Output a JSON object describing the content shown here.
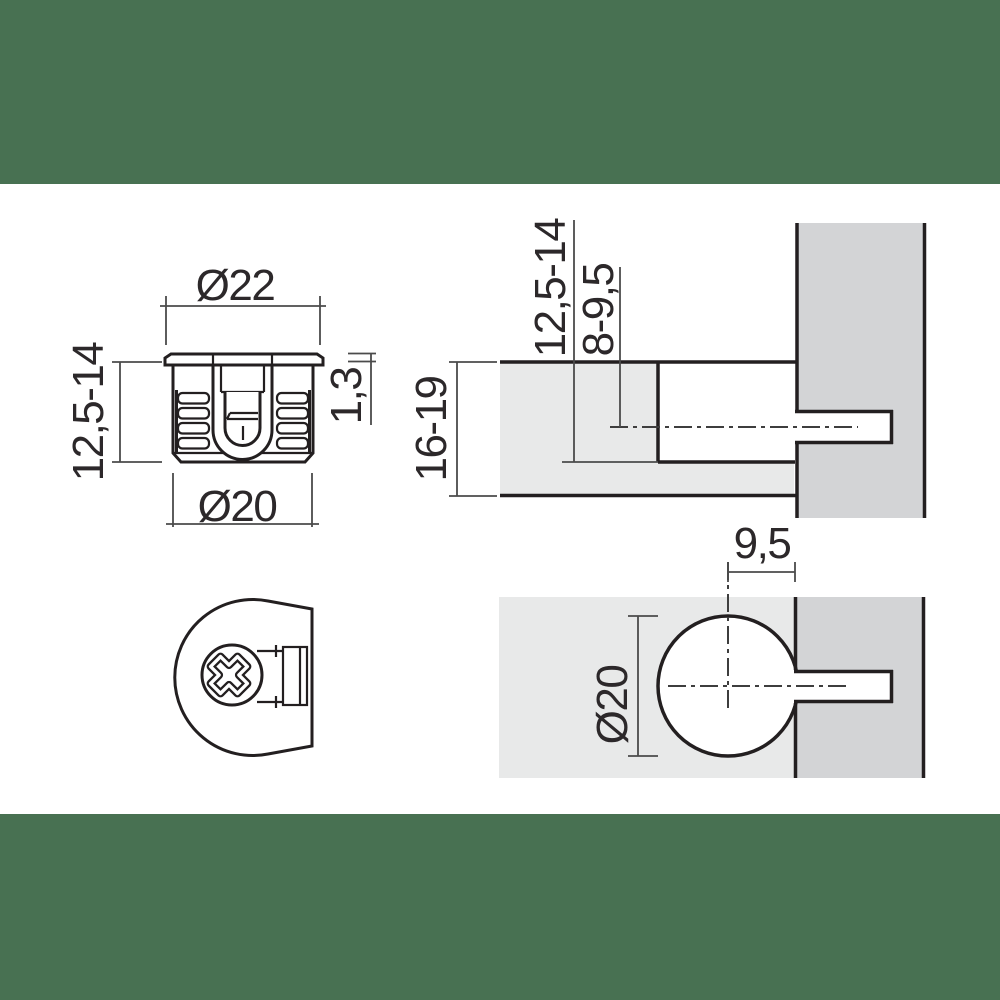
{
  "title": "Furniture cam fitting technical drawing",
  "colors": {
    "band": "#487152",
    "panel_light": "#E8E9E9",
    "panel_dark": "#D3D4D6",
    "outline": "#231F20",
    "dim_line": "#4B4B4B",
    "text": "#2C282A",
    "background": "#FFFFFF"
  },
  "cam_side_view": {
    "dim_top_diameter": "Ø22",
    "dim_height": "12,5-14",
    "dim_rim_height": "1,3",
    "dim_body_diameter": "Ø20"
  },
  "panel_section_view": {
    "dim_bore_depth": "12,5-14",
    "dim_axis_depth": "8-9,5",
    "dim_panel_thickness": "16-19"
  },
  "panel_plan_view": {
    "dim_edge_distance": "9,5",
    "dim_bore_diameter": "Ø20"
  }
}
